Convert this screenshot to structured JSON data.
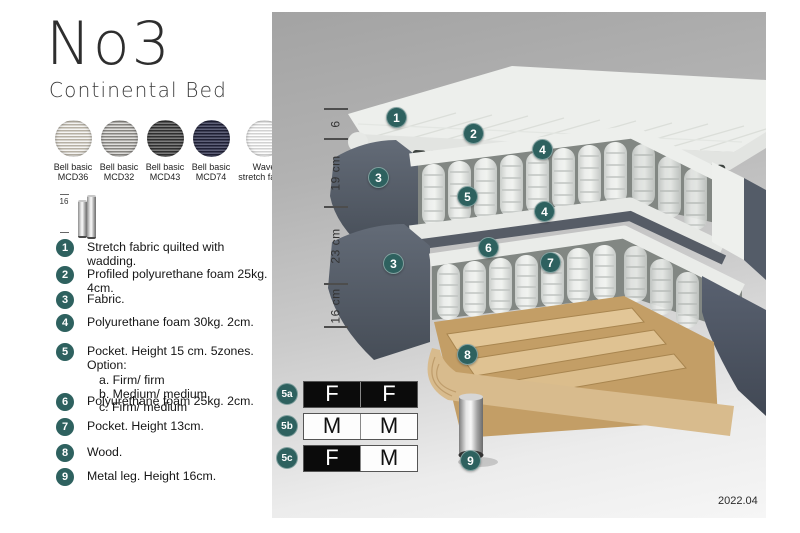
{
  "header": {
    "title": "No3",
    "subtitle": "Continental Bed"
  },
  "swatches": [
    {
      "name": "bell-basic-mcd36",
      "line1": "Bell basic",
      "line2": "MCD36"
    },
    {
      "name": "bell-basic-mcd32",
      "line1": "Bell basic",
      "line2": "MCD32"
    },
    {
      "name": "bell-basic-mcd43",
      "line1": "Bell basic",
      "line2": "MCD43"
    },
    {
      "name": "bell-basic-mcd74",
      "line1": "Bell basic",
      "line2": "MCD74"
    },
    {
      "name": "wave-stretch-fabric",
      "line1": "Wave",
      "line2": "stretch fabric"
    }
  ],
  "leg_figure": {
    "dimension": "16"
  },
  "legend": [
    {
      "num": "1",
      "text": "Stretch fabric quilted with wadding."
    },
    {
      "num": "2",
      "text": "Profiled polyurethane foam 25kg. 4cm."
    },
    {
      "num": "3",
      "text": "Fabric."
    },
    {
      "num": "4",
      "text": "Polyurethane foam 30kg. 2cm."
    },
    {
      "num": "5",
      "text": "Pocket. Height 15 cm. 5zones. Option:",
      "options": [
        "a. Firm/ firm",
        "b. Medium/ medium",
        "c. Firm/ medium"
      ]
    },
    {
      "num": "6",
      "text": "Polyurethane foam 25kg. 2cm."
    },
    {
      "num": "7",
      "text": "Pocket. Height 13cm."
    },
    {
      "num": "8",
      "text": "Wood."
    },
    {
      "num": "9",
      "text": "Metal leg. Height 16cm."
    }
  ],
  "diagram": {
    "dimensions": [
      {
        "label": "6"
      },
      {
        "label": "19 cm"
      },
      {
        "label": "23 cm"
      },
      {
        "label": "16 cm"
      }
    ],
    "callouts": [
      {
        "num": "1"
      },
      {
        "num": "2"
      },
      {
        "num": "4"
      },
      {
        "num": "3"
      },
      {
        "num": "5"
      },
      {
        "num": "4"
      },
      {
        "num": "6"
      },
      {
        "num": "7"
      },
      {
        "num": "3"
      },
      {
        "num": "8"
      },
      {
        "num": "9"
      }
    ],
    "firmness_options": [
      {
        "id": "5a",
        "cells": [
          {
            "label": "F",
            "style": "dark"
          },
          {
            "label": "F",
            "style": "dark"
          }
        ]
      },
      {
        "id": "5b",
        "cells": [
          {
            "label": "M",
            "style": "light"
          },
          {
            "label": "M",
            "style": "light"
          }
        ]
      },
      {
        "id": "5c",
        "cells": [
          {
            "label": "F",
            "style": "dark"
          },
          {
            "label": "M",
            "style": "light"
          }
        ]
      }
    ],
    "version": "2022.04"
  },
  "colors": {
    "accent_teal": "#2e615f",
    "firm_cell": "#0b0b0b",
    "fabric_dark": "#535b66",
    "wood": "#d8bb8d"
  }
}
